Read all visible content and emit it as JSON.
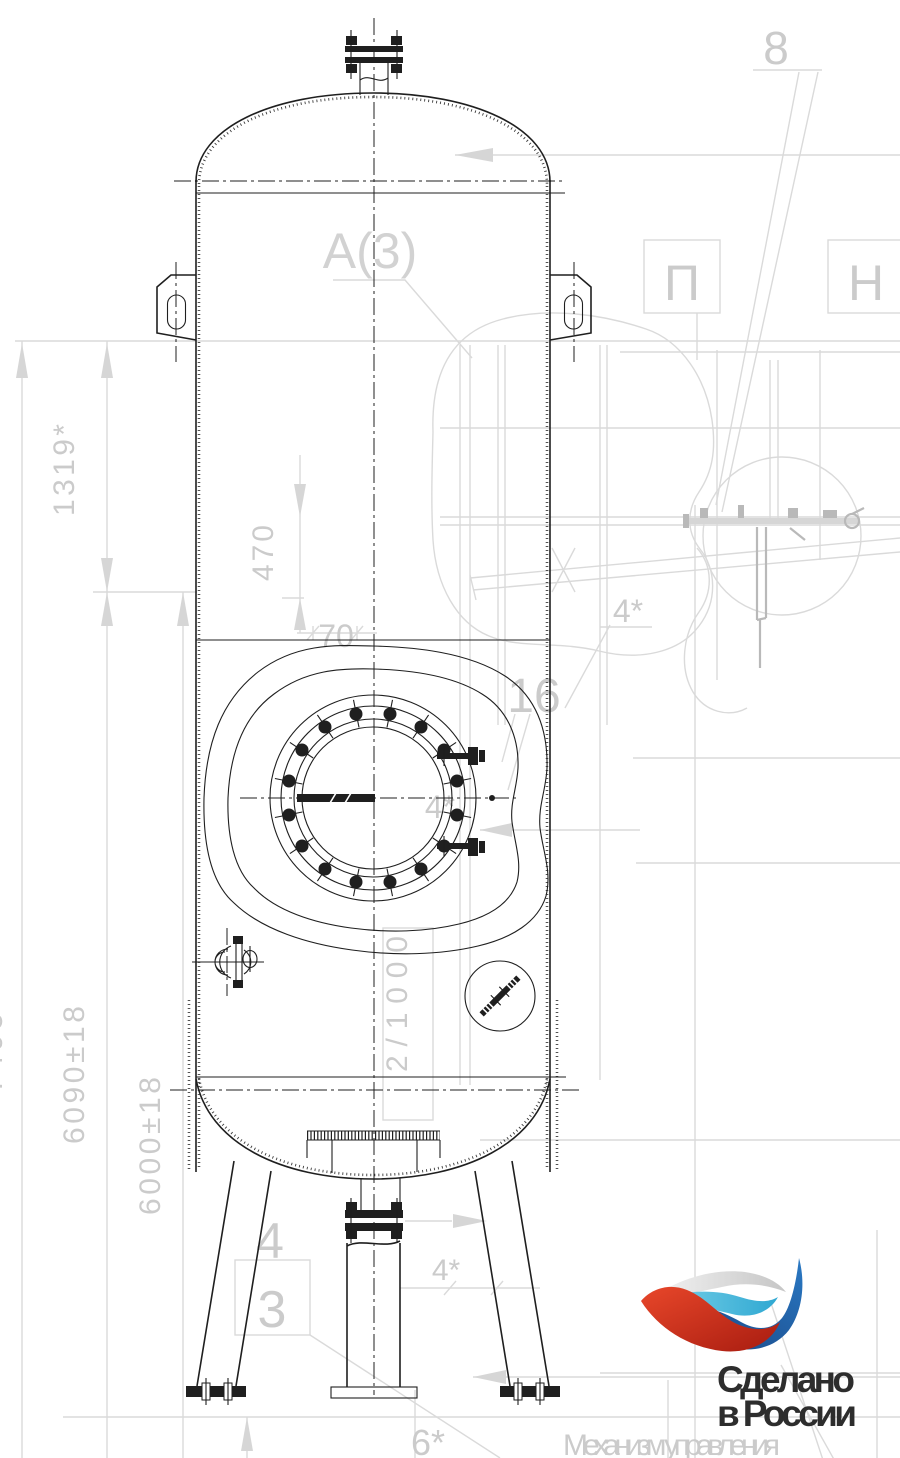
{
  "drawing": {
    "view_label": "A(3)",
    "callout_8": "8",
    "pos_p": "П",
    "pos_n": "Н",
    "callout_16": "16",
    "weld_4_upper": "4*",
    "weld_4_manhole": "4*",
    "weld_4_bottom": "4*",
    "weld_6_bottom": "6*",
    "item_4": "4",
    "detail_3": "3",
    "dim_1319": "1319*",
    "dim_470": "470",
    "dim_70": "70",
    "dim_7495": "7495*",
    "dim_6090": "6090±18",
    "dim_6000": "6000±18",
    "slope": "2/1000",
    "ghost_caption": "Механизм управления"
  },
  "logo": {
    "line1": "Сделано",
    "line2": "в России",
    "colors": {
      "red": "#cf3a20",
      "dark_blue": "#1d5ba6",
      "light_blue": "#45b5da",
      "silver": "#d9d9d9",
      "text": "#2d2d2d"
    }
  }
}
